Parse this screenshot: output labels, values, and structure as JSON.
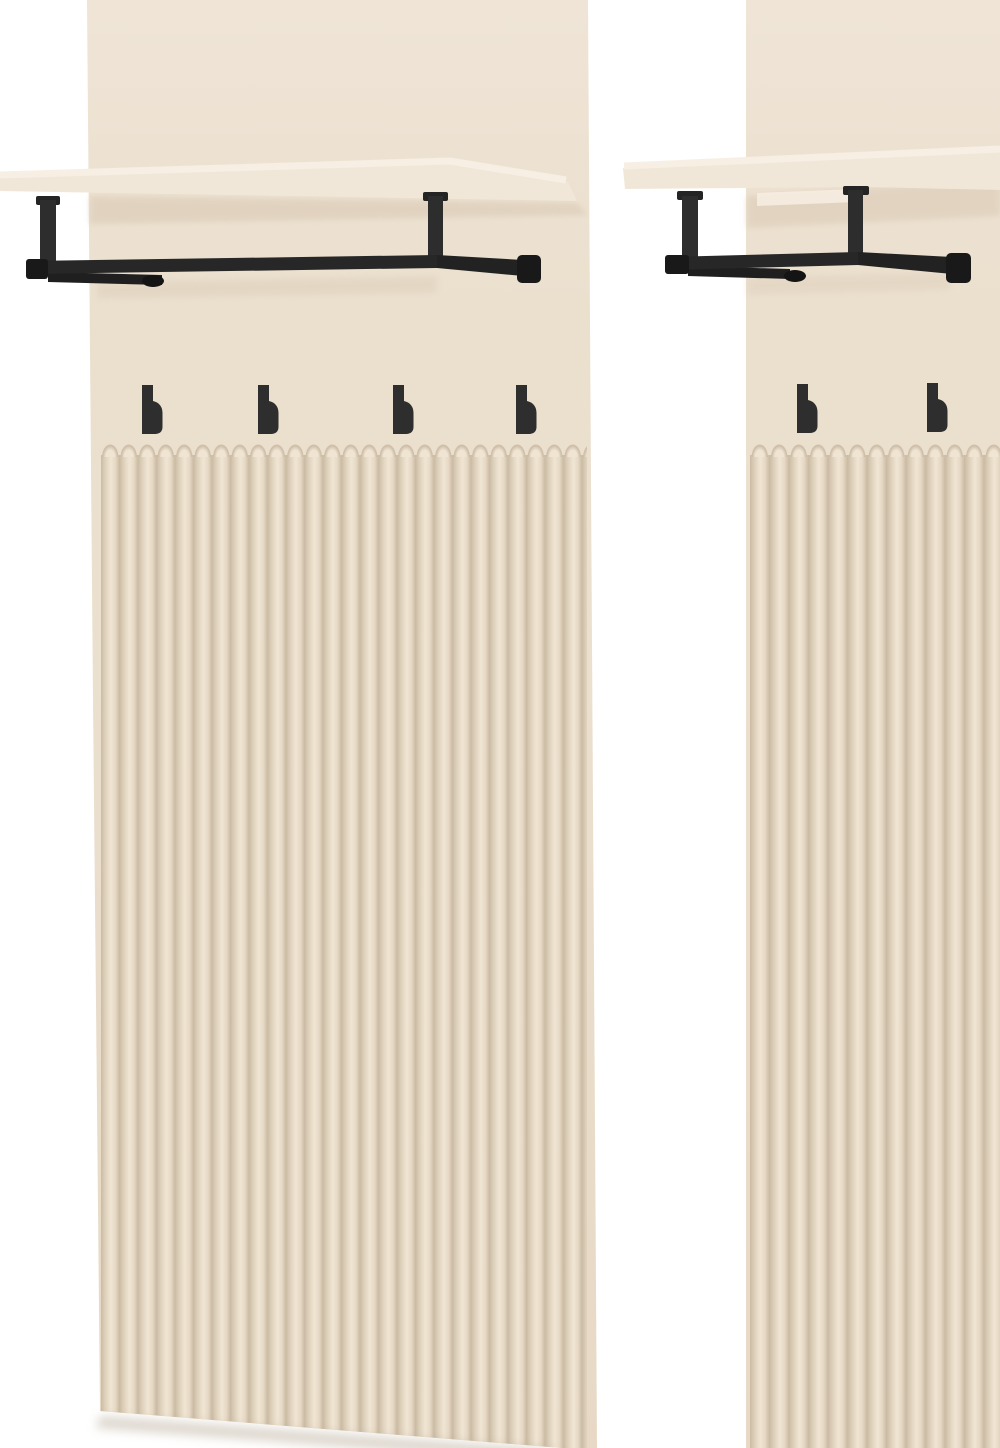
{
  "scene": {
    "type": "furniture-product-photo",
    "subject": "two beige fluted wall-mounted hallway coat-rack panels",
    "panel_count": 2
  },
  "panels": {
    "left": {
      "hook_count": 4,
      "has_shelf": true,
      "has_hanging_rail": true,
      "fluted_lower_section": true
    },
    "right": {
      "hook_count": 2,
      "has_shelf": true,
      "has_hanging_rail": true,
      "fluted_lower_section": true,
      "cropped_at_right_edge": true
    }
  },
  "colors": {
    "background": "#ffffff",
    "panel": "#ebdfce",
    "panel_light": "#efe4d6",
    "panel_dark": "#e7d9c5",
    "flute_groove": "#cbbba4",
    "flute_dark": "#ddd0bb",
    "flute_mid": "#ebdfcc",
    "flute_light": "#f0e5d3",
    "flute_mid2": "#e6d9c5",
    "shelf_face": "#f1e7d8",
    "shelf_highlight": "#f7efe3",
    "under_shelf_shadow": "#dccdb8",
    "drop_shadow": "#b3a48f",
    "metal": "#272727",
    "metal_dark": "#191919",
    "metal_mid": "#2d2d2d",
    "hook": "#2e2e2e"
  }
}
